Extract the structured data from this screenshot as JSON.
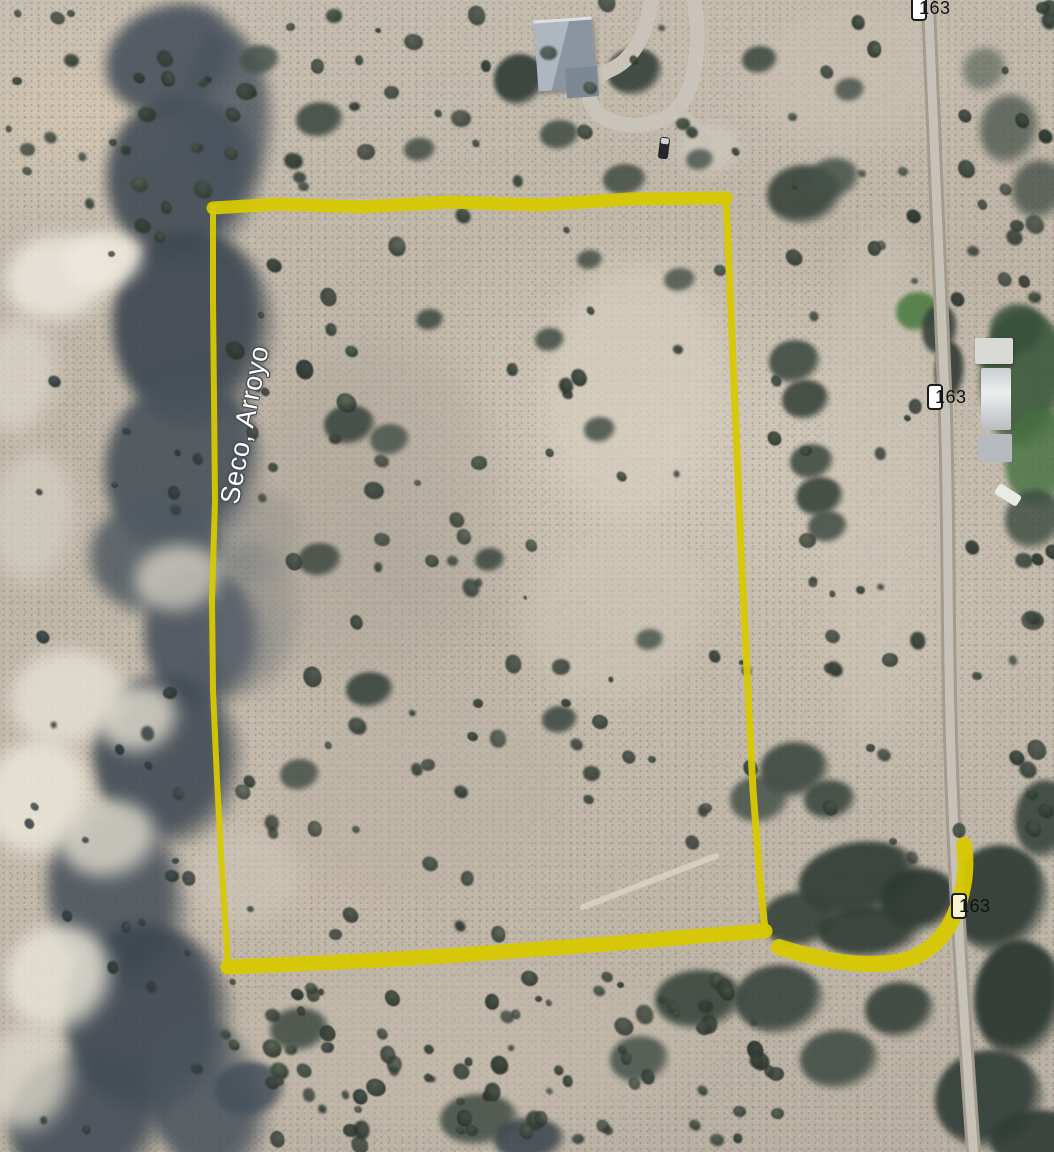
{
  "map": {
    "description": "Satellite aerial view of a desert land parcel outlined in yellow beside highway 163 and a dry arroyo",
    "place_label": {
      "text": "Seco, Arroyo"
    },
    "route_badges": [
      {
        "label": "163"
      },
      {
        "label": "163"
      },
      {
        "label": "163"
      }
    ],
    "parcel_boundary": {
      "color": "#d7c900",
      "edges": [
        {
          "width": 13,
          "opacity": 0.95,
          "points": [
            [
              213,
              208
            ],
            [
              280,
              204
            ],
            [
              360,
              207
            ],
            [
              450,
              202
            ],
            [
              540,
              205
            ],
            [
              630,
              199
            ],
            [
              726,
              198
            ]
          ]
        },
        {
          "width": 7,
          "opacity": 0.95,
          "points": [
            [
              726,
              198
            ],
            [
              731,
              310
            ],
            [
              736,
              430
            ],
            [
              741,
              550
            ],
            [
              747,
              670
            ],
            [
              753,
              790
            ],
            [
              760,
              880
            ],
            [
              765,
              930
            ]
          ]
        },
        {
          "width": 15,
          "opacity": 0.95,
          "points": [
            [
              765,
              931
            ],
            [
              700,
              936
            ],
            [
              620,
              943
            ],
            [
              540,
              949
            ],
            [
              460,
              955
            ],
            [
              380,
              960
            ],
            [
              300,
              964
            ],
            [
              228,
              967
            ]
          ]
        },
        {
          "width": 6,
          "opacity": 0.95,
          "points": [
            [
              228,
              967
            ],
            [
              222,
              870
            ],
            [
              217,
              780
            ],
            [
              213,
              690
            ],
            [
              212,
              600
            ],
            [
              215,
              500
            ],
            [
              214,
              400
            ],
            [
              213,
              300
            ],
            [
              213,
              208
            ]
          ]
        }
      ]
    },
    "access_path": {
      "color": "#d7c900",
      "width": 16,
      "opacity": 0.95,
      "d": "M 779,947 C 810,957 850,967 890,963 C 928,959 949,934 959,903 C 967,878 966,858 964,845"
    }
  }
}
